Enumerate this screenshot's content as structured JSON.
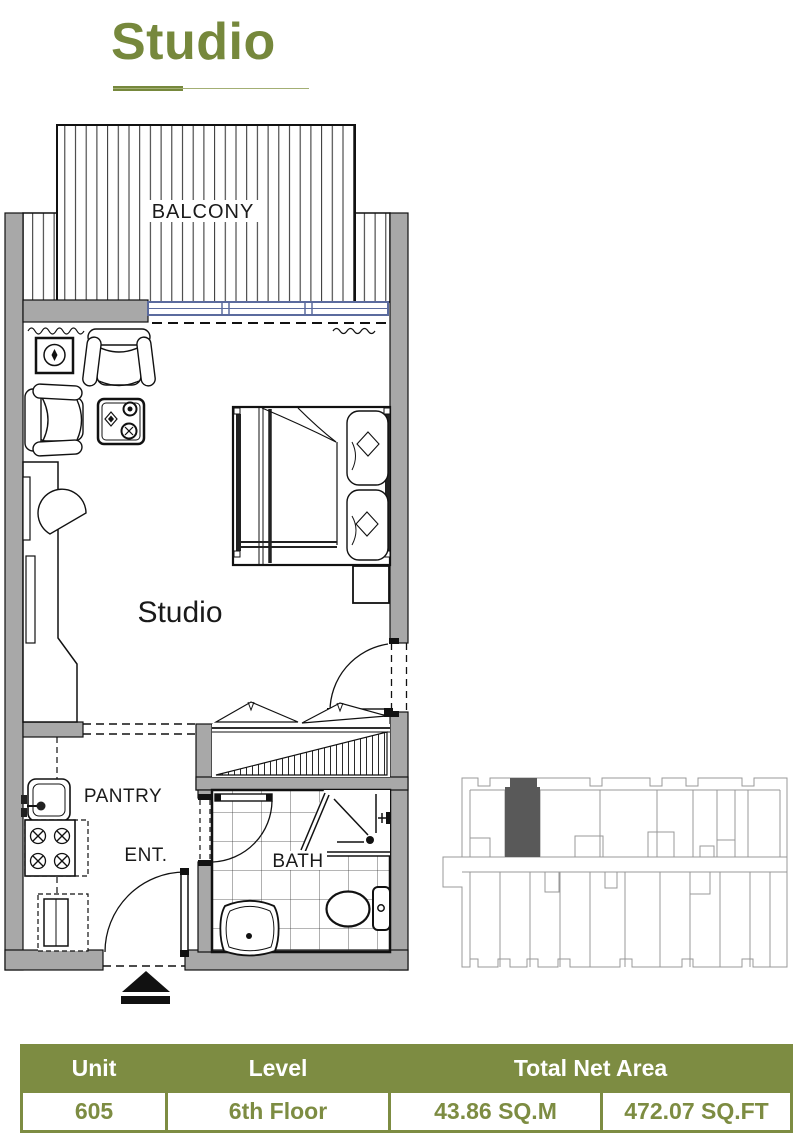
{
  "page": {
    "title": "Studio"
  },
  "floor_plan": {
    "labels": {
      "balcony": "BALCONY",
      "studio": "Studio",
      "pantry": "PANTRY",
      "entrance": "ENT.",
      "bath": "BATH"
    },
    "icons": [
      "entry-arrow-icon"
    ]
  },
  "locator": {
    "highlight": "unit-605-position"
  },
  "colors": {
    "accent_green": "#7d8c42",
    "title_green": "#76883c",
    "wall_gray": "#a8a8a8",
    "window_blue": "#5b6b9e",
    "unit_highlight": "#595959"
  },
  "table": {
    "headers": [
      "Unit",
      "Level",
      "Total Net Area"
    ],
    "row": {
      "unit": "605",
      "level": "6th Floor",
      "area_sqm": "43.86 SQ.M",
      "area_sqft": "472.07 SQ.FT"
    }
  }
}
